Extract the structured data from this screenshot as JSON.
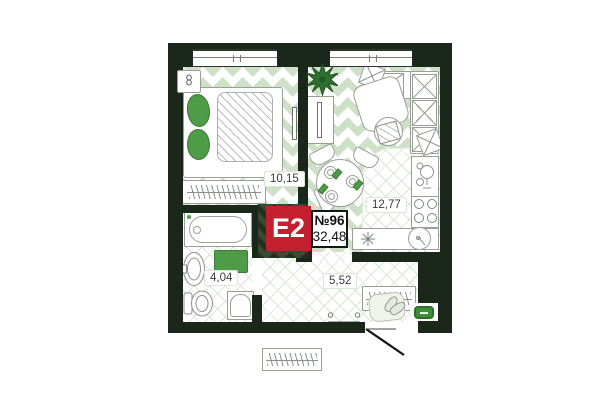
{
  "plan": {
    "badge": {
      "layout_code": "E2",
      "apartment_number": "№96",
      "total_area": "32,48"
    },
    "rooms": {
      "bedroom": {
        "name": "bedroom",
        "area": "10,15"
      },
      "kitchen_living": {
        "name": "kitchen-living-room",
        "area": "12,77"
      },
      "bathroom": {
        "name": "bathroom",
        "area": "4,04"
      },
      "hallway": {
        "name": "hallway",
        "area": "5,52"
      }
    },
    "colors": {
      "wall_dark_green": "#1c271b",
      "parquet_green": "#cee0c8",
      "tile_line_green": "#d8e9d2",
      "furniture_accent_green": "#4f9b47",
      "plant_green": "#2f7030",
      "badge_red": "#c2202f",
      "outline_gray": "#98a096"
    },
    "icons": [
      "plant-icon",
      "stove-burners-icon",
      "kitchen-sink-icon",
      "round-basin-icon",
      "cooktop-star-icon",
      "door-swing-line",
      "radiator-squiggle-icon",
      "toilet-icon",
      "bath-sink-icon",
      "shoes-icon",
      "bench-icon"
    ]
  }
}
